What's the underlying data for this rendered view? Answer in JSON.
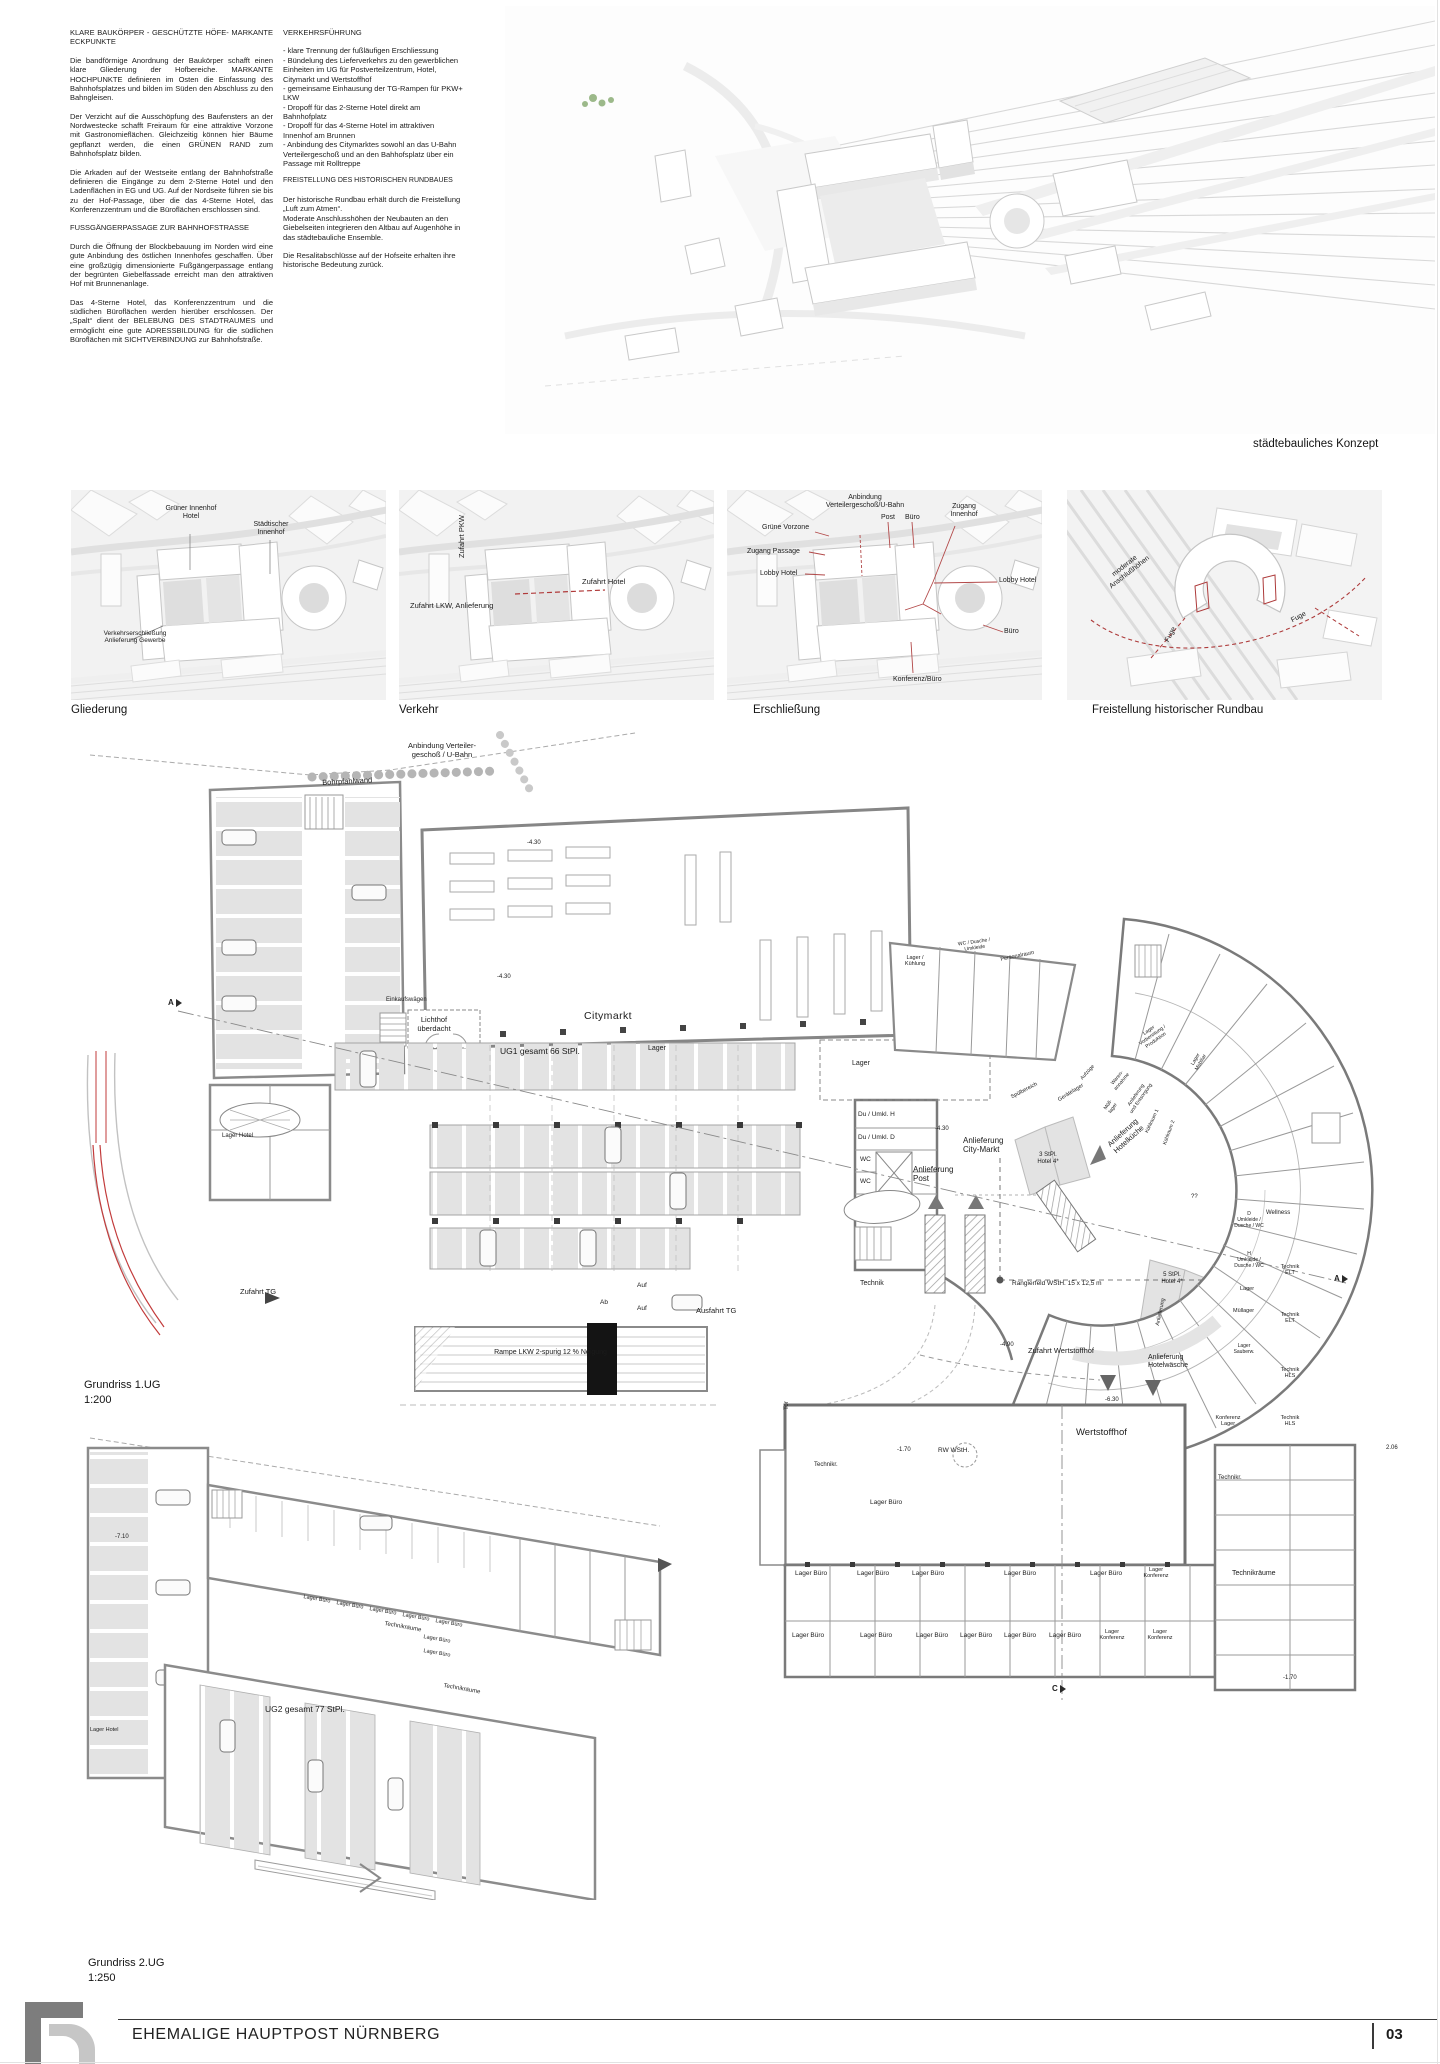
{
  "header": {
    "number": "490490"
  },
  "intro": {
    "col1": {
      "h1": "KLARE BAUKÖRPER - GESCHÜTZTE HÖFE- MARKANTE ECKPUNKTE",
      "p1": "Die bandförmige Anordnung der Baukörper schaf­ft einen klare Gliederung der Hofbereiche. MARKANTE HOCHPUNKTE definieren im Osten die Einfassung des Bahnhofsplatzes und bilden im Süden den Abschluss zu den Bahngleisen.",
      "p2": "Der Verzicht auf die Ausschöpfung des Baufensters an der Nordwestecke schafft Freiraum für eine attraktive Vorzone mit Gastronomieflächen. Gleichzeitig können hier Bäume gepflanzt werden, die einen GRÜNEN RAND zum Bahnhofsplatz bilden.",
      "p3": "Die Arkaden auf der Westseite entlang der Bahnhofstraße definieren die Eingänge zu dem 2-Sterne Hotel und den Ladenflächen in EG und UG. Auf der Nordseite führen sie bis zu der Hof-Passage, über die das 4-Sterne Hotel, das Konferenzzentrum und die Büroflächen erschlossen sind.",
      "h2": "FUSSGÄNGERPASSAGE ZUR BAHNHOFSTRASSE",
      "p4": "Durch die Öffnung der Blockbebauung im Norden wird eine gute Anbindung des östlichen Innenhofes geschaffen. Über eine großzügig dimensionierte Fußgängerpassage entlang der begrünten Giebelfassade erreicht man den attraktiven Hof mit Brunnenanlage.",
      "p5": "Das 4-Sterne Hotel, das Konferenzzentrum und die südlichen Büroflächen werden hierüber erschlossen. Der „Spalt“ dient der BELEBUNG DES STADTRAUMES und ermöglicht eine gute ADRESSBILDUNG für die südlichen Büroflächen mit SICHTVERBINDUNG zur Bahnhofstraße."
    },
    "col2": {
      "h1": "VERKEHRSFÜHRUNG",
      "b0": "- klare Trennung der fußläufigen Erschliessung",
      "b1": "- Bündelung des Lieferverkehrs zu den gewerblichen Einheiten im UG für Postverteilzentrum, Hotel, Citymarkt und Wertstoffhof",
      "b2": "- gemeinsame Einhausung der TG-Rampen für PKW+ LKW",
      "b3": "- Dropoff für das 2-Sterne Hotel direkt am Bahnhofplatz",
      "b4": "- Dropoff für das 4-Sterne Hotel im attraktiven Innenhof am Brunnen",
      "b5": "- Anbindung des Citymarktes sowohl an das U-Bahn Verteilergeschoß und an den Bahhofsplatz über ein Passage mit Rolltreppe",
      "h2": "FREISTELLUNG DES HISTORISCHEN RUNDBAUES",
      "p1": "Der historische Rundbau erhält durch die Freistellung „Luft zum Atmen“.",
      "p2": "Moderate Anschlusshöhen der Neubauten an den Giebelseiten integrieren den Altbau auf Augenhöhe in das städtebauliche Ensemble.",
      "p3": "Die Resalitabschlüsse auf der Hofseite erhalten ihre historische Bedeutung zurück."
    }
  },
  "concept": {
    "caption": "städtebauliches Konzept"
  },
  "diagrams": {
    "d1": {
      "caption": "Gliederung",
      "gruener": "Grüner Innenhof\nHotel",
      "staedtischer": "Städtischer\nInnenhof",
      "verkehr": "Verkehrserschließung\nAnlieferung Gewerbe"
    },
    "d2": {
      "caption": "Verkehr",
      "pkw": "Zufahrt PKW",
      "hotel": "Zufahrt Hotel",
      "lkw": "Zufahrt LKW, Anlieferung"
    },
    "d3": {
      "caption": "Erschließung",
      "anbindung": "Anbindung\nVerteilergeschoß/U-Bahn",
      "vorzone": "Grüne Vorzone",
      "post": "Post",
      "buero": "Büro",
      "zugang_innenhof": "Zugang\nInnenhof",
      "zugang_passage": "Zugang Passage",
      "lobby": "Lobby Hotel",
      "konferenz": "Konferenz/Büro"
    },
    "d4": {
      "caption": "Freistellung historischer Rundbau",
      "moderate": "moderate\nAnschlußhöhen",
      "fuge": "Fuge"
    }
  },
  "plan1": {
    "title": "Grundriss 1.UG",
    "scale": "1:200",
    "labels": {
      "anbindung": "Anbindung Verteiler-\ngeschoß / U-Bahn",
      "bohrpfahlwand": "Bohrpfahlwand",
      "einkaufswaegen": "Einkaufswägen",
      "lichthof": "Lichthof\nüberdacht",
      "citymarkt": "Citymarkt",
      "ug1": "UG1 gesamt 66 StPl.",
      "lager_hotel": "Lager Hotel",
      "zufahrt_tg": "Zufahrt TG",
      "rampe": "Rampe LKW 2-spurig 12 % Neigung",
      "auf": "Auf",
      "ab": "Ab",
      "ausfahrt_tg": "Ausfahrt TG",
      "lager": "Lager",
      "du_h": "Du / Umkl. H",
      "du_d": "Du / Umkl. D",
      "wc": "WC",
      "anl_post": "Anlieferung\nPost",
      "anl_citymarkt": "Anlieferung\nCity-Markt",
      "technik": "Technik",
      "stpl3": "3 StPl.\nHotel 4*",
      "anl_hotelkueche": "Anlieferung\nHotelküche",
      "rangierfeld": "Rangierfeld WStH. 15 x 12,5 m",
      "stpl5": "5 StPl.\nHotel 4*",
      "lager_kuehlung": "Lager /\nKühlung",
      "wc_dusche": "WC / Dusche /\nUmkleide",
      "personalraum": "Personalraum",
      "lager_vorb": "Lager\nVorbereitung /\nProduktion",
      "aufzuege": "Aufzüge",
      "spuelbereich": "Spülbereich",
      "geraetelager": "Gerätelager",
      "warenannahme": "Waren-\nannahme",
      "muell_kurz": "Müll-\nlager",
      "anl_entsorgung": "Anlieferung\nund Entsorgung",
      "kuehlraum1": "Kühlraum 1",
      "kuehlraum2": "Kühlraum 2",
      "lager_mobiliar": "Lager\nMobiliar",
      "fragezeichen": "??",
      "d_umkl": "D\nUmkleide /\nDusche / WC",
      "h_umkl": "H\nUmkleide /\nDusche / WC",
      "wellness": "Wellness",
      "muellager": "Müllager",
      "technik_elt": "Technik\nELT",
      "technik_hls": "Technik\nHLS",
      "anlieferung": "Anlieferung",
      "lager_sauber": "Lager\nSauberw.",
      "konferenz_lager": "Konferenz\nLager",
      "zufahrt_wsh": "Zufahrt Wertstoffhof",
      "anl_hotelwaesche": "Anlieferung\nHotelwäsche",
      "wertstoffhof": "Wertstoffhof",
      "rw_wsth": "RW WStH.",
      "technikr": "Technikr.",
      "lager_buero": "Lager Büro",
      "lager_konferenz": "Lager\nKonferenz",
      "technikraeume": "Technikräume",
      "tor": "Tor",
      "m430": "-4.30",
      "m490": "-4.90",
      "m630": "-6.30",
      "m170": "-1.70",
      "p206": "2.06",
      "a": "A",
      "c": "C"
    }
  },
  "plan2": {
    "title": "Grundriss 2.UG",
    "scale": "1:250",
    "labels": {
      "ug2": "UG2 gesamt 77 StPl.",
      "lager_buero": "Lager Büro",
      "technikraeume": "Technikräume",
      "lager_hotel": "Lager Hotel",
      "m710": "-7.10"
    }
  },
  "footer": {
    "project": "EHEMALIGE HAUPTPOST NÜRNBERG",
    "page": "03"
  }
}
